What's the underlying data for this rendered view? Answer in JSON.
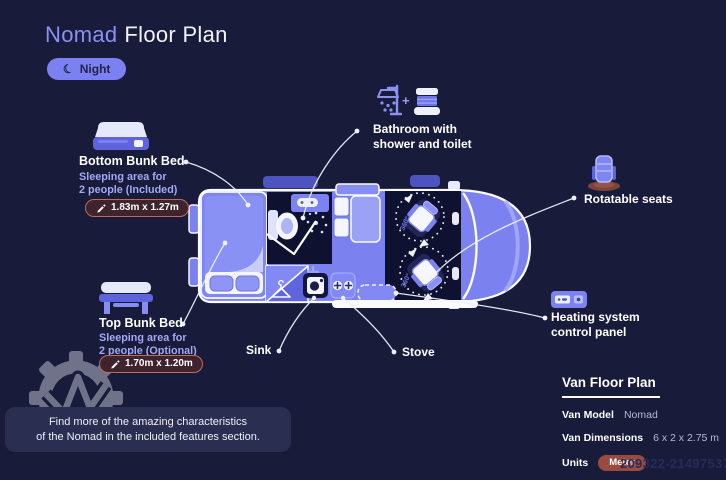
{
  "colors": {
    "background": "#181b3a",
    "accent_periwinkle": "#7b82f0",
    "brand_text": "#8a90f5",
    "dark_interior": "#0e1130",
    "dimension_badge_border": "#c06a58",
    "dimension_badge_bg": "#3f232d",
    "meter_badge": "#9a4b40",
    "info_box": "#2a2e51"
  },
  "header": {
    "title_brand": "Nomad",
    "title_rest": "Floor Plan",
    "mode_label": "Night",
    "moon_icon": "☾"
  },
  "callouts": {
    "bottom_bunk": {
      "title": "Bottom Bunk Bed",
      "sub1": "Sleeping area for",
      "sub2": "2 people (Included)",
      "dim": "1.83m x 1.27m"
    },
    "top_bunk": {
      "title": "Top Bunk Bed",
      "sub1": "Sleeping area for",
      "sub2": "2 people (Optional)",
      "dim": "1.70m x 1.20m"
    },
    "bathroom": {
      "line1": "Bathroom with",
      "line2": "shower and toilet",
      "plus": "+"
    },
    "rotatable_seats": {
      "label": "Rotatable seats"
    },
    "heating": {
      "line1": "Heating system",
      "line2": "control panel"
    },
    "sink": {
      "label": "Sink"
    },
    "stove": {
      "label": "Stove"
    }
  },
  "floor_plan": {
    "rotation_label": "360°"
  },
  "spec_panel": {
    "heading": "Van Floor Plan",
    "rows": [
      {
        "label": "Van Model",
        "value": "Nomad"
      },
      {
        "label": "Van Dimensions",
        "value": "6 x 2 x 2.75 m"
      },
      {
        "label": "Units",
        "value": "Meter"
      }
    ]
  },
  "footer_note": {
    "line1": "Find more of the amazing characteristics",
    "line2": "of the Nomad in the included features section."
  },
  "watermark": {
    "number": "209322-21497537"
  }
}
